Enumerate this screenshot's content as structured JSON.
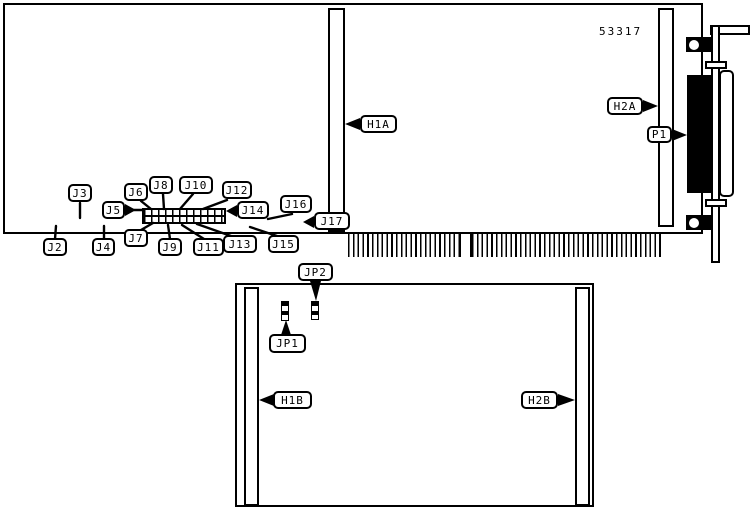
{
  "figure": {
    "part_number": "53317"
  },
  "board_top": {
    "callouts": {
      "J2": "J2",
      "J3": "J3",
      "J4": "J4",
      "J5": "J5",
      "J6": "J6",
      "J7": "J7",
      "J8": "J8",
      "J9": "J9",
      "J10": "J10",
      "J11": "J11",
      "J12": "J12",
      "J13": "J13",
      "J14": "J14",
      "J15": "J15",
      "J16": "J16",
      "J17": "J17",
      "H1A": "H1A",
      "H2A": "H2A",
      "P1": "P1"
    }
  },
  "board_bottom": {
    "callouts": {
      "JP1": "JP1",
      "JP2": "JP2",
      "H1B": "H1B",
      "H2B": "H2B"
    }
  }
}
